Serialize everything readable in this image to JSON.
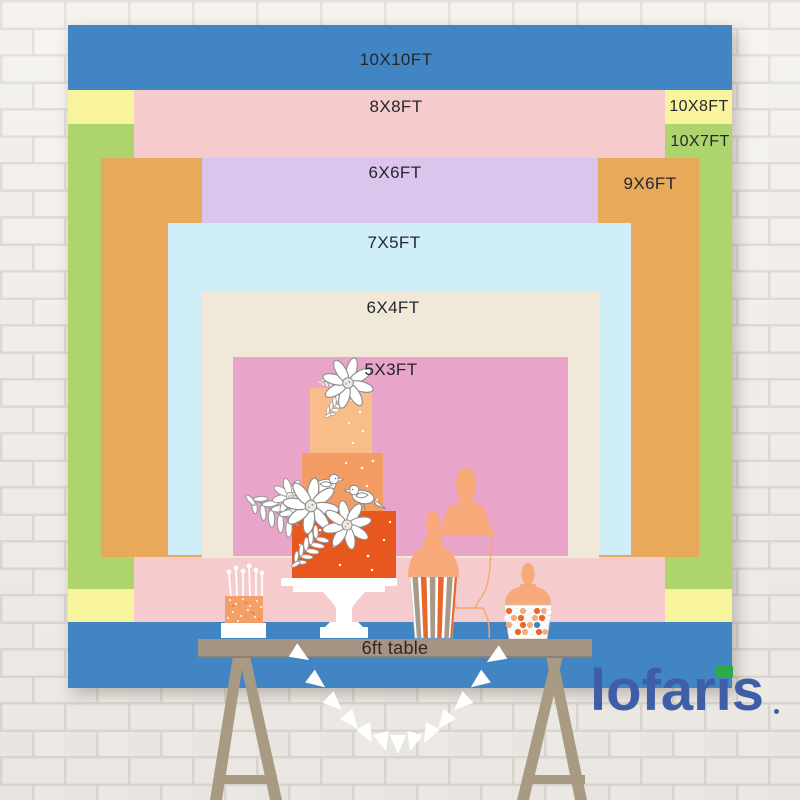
{
  "product": {
    "type": "backdrop-size-comparison-chart",
    "sizes": [
      {
        "label": "10X10FT",
        "color": "#4285c5"
      },
      {
        "label": "8X8FT",
        "color": "#f6cbce"
      },
      {
        "label": "10X8FT",
        "color": "#f8f49e"
      },
      {
        "label": "10X7FT",
        "color": "#aed46e"
      },
      {
        "label": "6X6FT",
        "color": "#dcc5ec"
      },
      {
        "label": "9X6FT",
        "color": "#e9a95b"
      },
      {
        "label": "7X5FT",
        "color": "#d0eef7"
      },
      {
        "label": "6X4FT",
        "color": "#f0e9d9"
      },
      {
        "label": "5X3FT",
        "color": "#e9a4c9"
      }
    ],
    "table_label": "6ft table",
    "brand": "lofaris",
    "colors": {
      "logo_blue": "#3e5fa8",
      "logo_green": "#2faa49",
      "table_brown": "#a59384",
      "wall_white": "#f3f0ec"
    }
  }
}
